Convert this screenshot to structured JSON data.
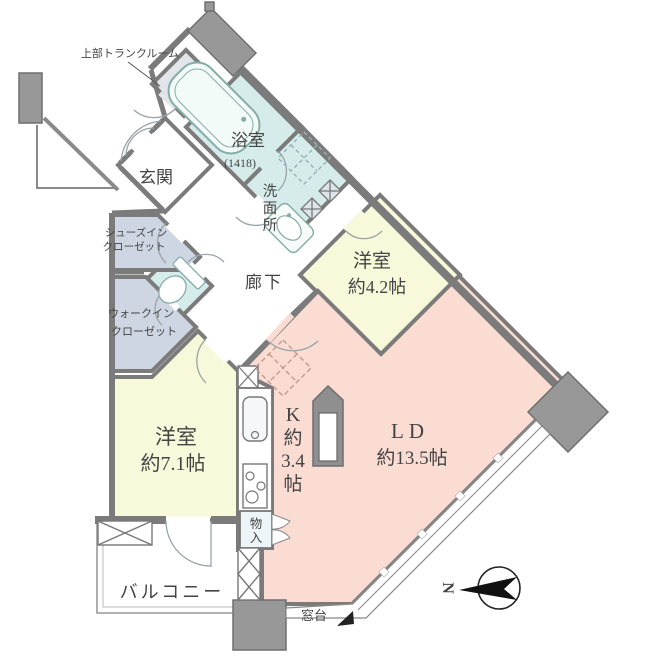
{
  "colors": {
    "wall": "#7b7b7b",
    "pillar": "#989898",
    "pillar_dark": "#8f8f8f",
    "wet": "#d6eceb",
    "bedroom": "#f8f9da",
    "living": "#fbdcd3",
    "closet": "#cdd6e2",
    "trunk": "#e2e5e9",
    "storage": "#eef5f9",
    "white": "#ffffff",
    "text": "#444444"
  },
  "labels": {
    "trunk_note": "上部トランクルーム",
    "genkan": "玄関",
    "bathroom": "浴室",
    "bathroom_size": "(1418)",
    "washroom_c1": "洗",
    "washroom_c2": "面",
    "washroom_c3": "所",
    "corridor": "廊下",
    "sic_1": "シューズイン",
    "sic_2": "クローゼット",
    "wic_1": "ウォークイン",
    "wic_2": "クローゼット",
    "west_small_1": "洋室",
    "west_small_2": "約4.2帖",
    "west_large_1": "洋室",
    "west_large_2": "約7.1帖",
    "kitchen_1": "K",
    "kitchen_2": "約",
    "kitchen_3": "3.4",
    "kitchen_4": "帖",
    "ld_1": "LD",
    "ld_2": "約13.5帖",
    "storage_c1": "物",
    "storage_c2": "入",
    "balcony": "バルコニー",
    "madodai": "窓台",
    "north": "N"
  }
}
